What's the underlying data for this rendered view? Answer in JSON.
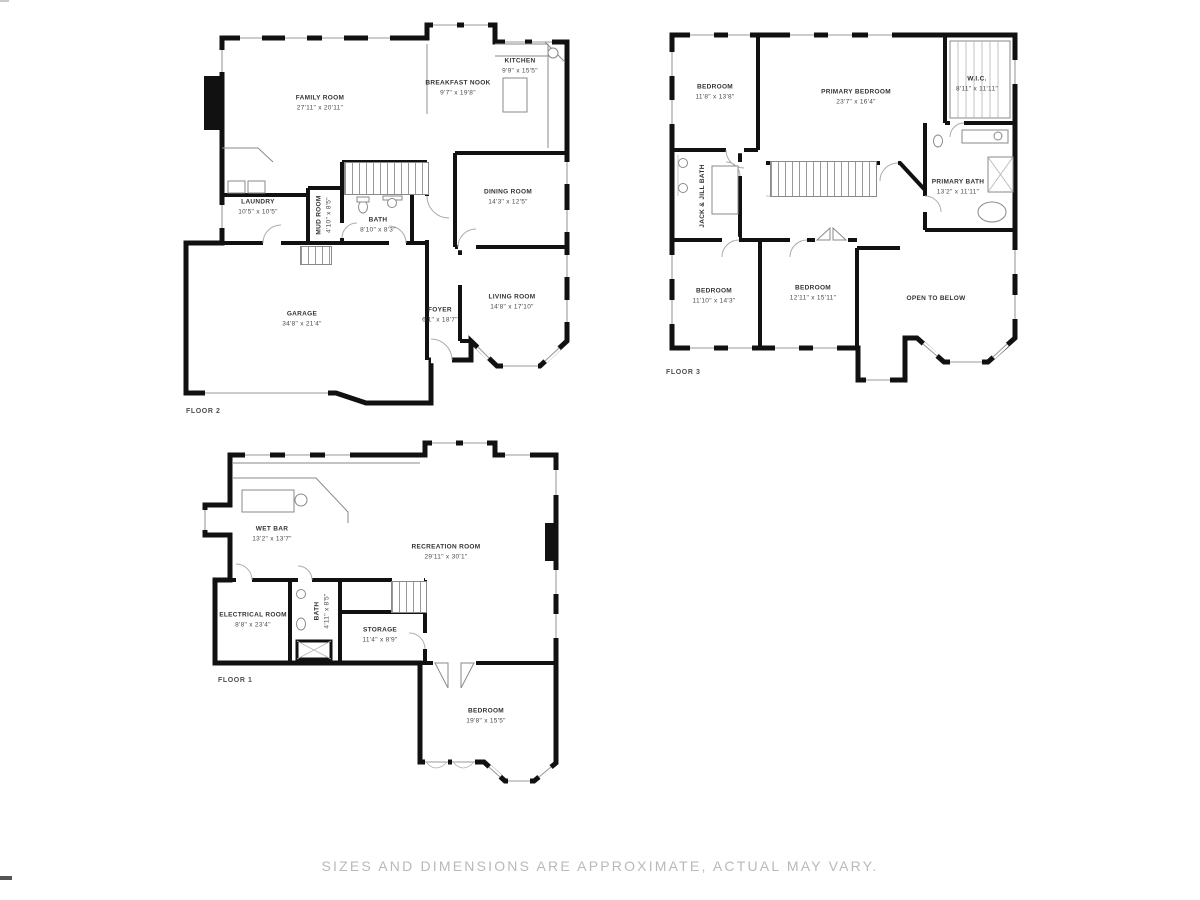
{
  "page": {
    "disclaimer": "SIZES AND DIMENSIONS ARE APPROXIMATE, ACTUAL MAY VARY.",
    "background_color": "#ffffff",
    "wall_color": "#111111",
    "label_color": "#3d3d3d",
    "disclaimer_color": "#b9b9b9"
  },
  "floors": [
    {
      "id": "floor-2",
      "label": "FLOOR 2",
      "rooms": [
        {
          "name": "FAMILY ROOM",
          "dims": "27'11\" x 20'11\""
        },
        {
          "name": "BREAKFAST NOOK",
          "dims": "9'7\" x 19'8\""
        },
        {
          "name": "KITCHEN",
          "dims": "9'9\" x 15'5\""
        },
        {
          "name": "LAUNDRY",
          "dims": "10'5\" x 10'5\""
        },
        {
          "name": "MUD ROOM",
          "dims": "4'10\" x 8'5\""
        },
        {
          "name": "BATH",
          "dims": "8'10\" x 8'3\""
        },
        {
          "name": "DINING ROOM",
          "dims": "14'3\" x 12'5\""
        },
        {
          "name": "GARAGE",
          "dims": "34'8\" x 21'4\""
        },
        {
          "name": "FOYER",
          "dims": "6'1\" x 18'7\""
        },
        {
          "name": "LIVING ROOM",
          "dims": "14'8\" x 17'10\""
        }
      ]
    },
    {
      "id": "floor-3",
      "label": "FLOOR 3",
      "rooms": [
        {
          "name": "BEDROOM",
          "dims": "11'8\" x 13'8\""
        },
        {
          "name": "PRIMARY BEDROOM",
          "dims": "23'7\" x 16'4\""
        },
        {
          "name": "W.I.C.",
          "dims": "8'11\" x 11'11\""
        },
        {
          "name": "PRIMARY BATH",
          "dims": "13'2\" x 11'11\""
        },
        {
          "name": "JACK & JILL BATH",
          "dims": ""
        },
        {
          "name": "BEDROOM",
          "dims": "11'10\" x 14'3\""
        },
        {
          "name": "BEDROOM",
          "dims": "12'11\" x 15'11\""
        },
        {
          "name": "OPEN TO BELOW",
          "dims": ""
        }
      ]
    },
    {
      "id": "floor-1",
      "label": "FLOOR 1",
      "rooms": [
        {
          "name": "WET BAR",
          "dims": "13'2\" x 13'7\""
        },
        {
          "name": "RECREATION ROOM",
          "dims": "29'11\" x 30'1\""
        },
        {
          "name": "ELECTRICAL ROOM",
          "dims": "8'8\" x 23'4\""
        },
        {
          "name": "BATH",
          "dims": "4'11\" x 8'5\""
        },
        {
          "name": "STORAGE",
          "dims": "11'4\" x 8'9\""
        },
        {
          "name": "BEDROOM",
          "dims": "19'8\" x 15'5\""
        }
      ]
    }
  ]
}
